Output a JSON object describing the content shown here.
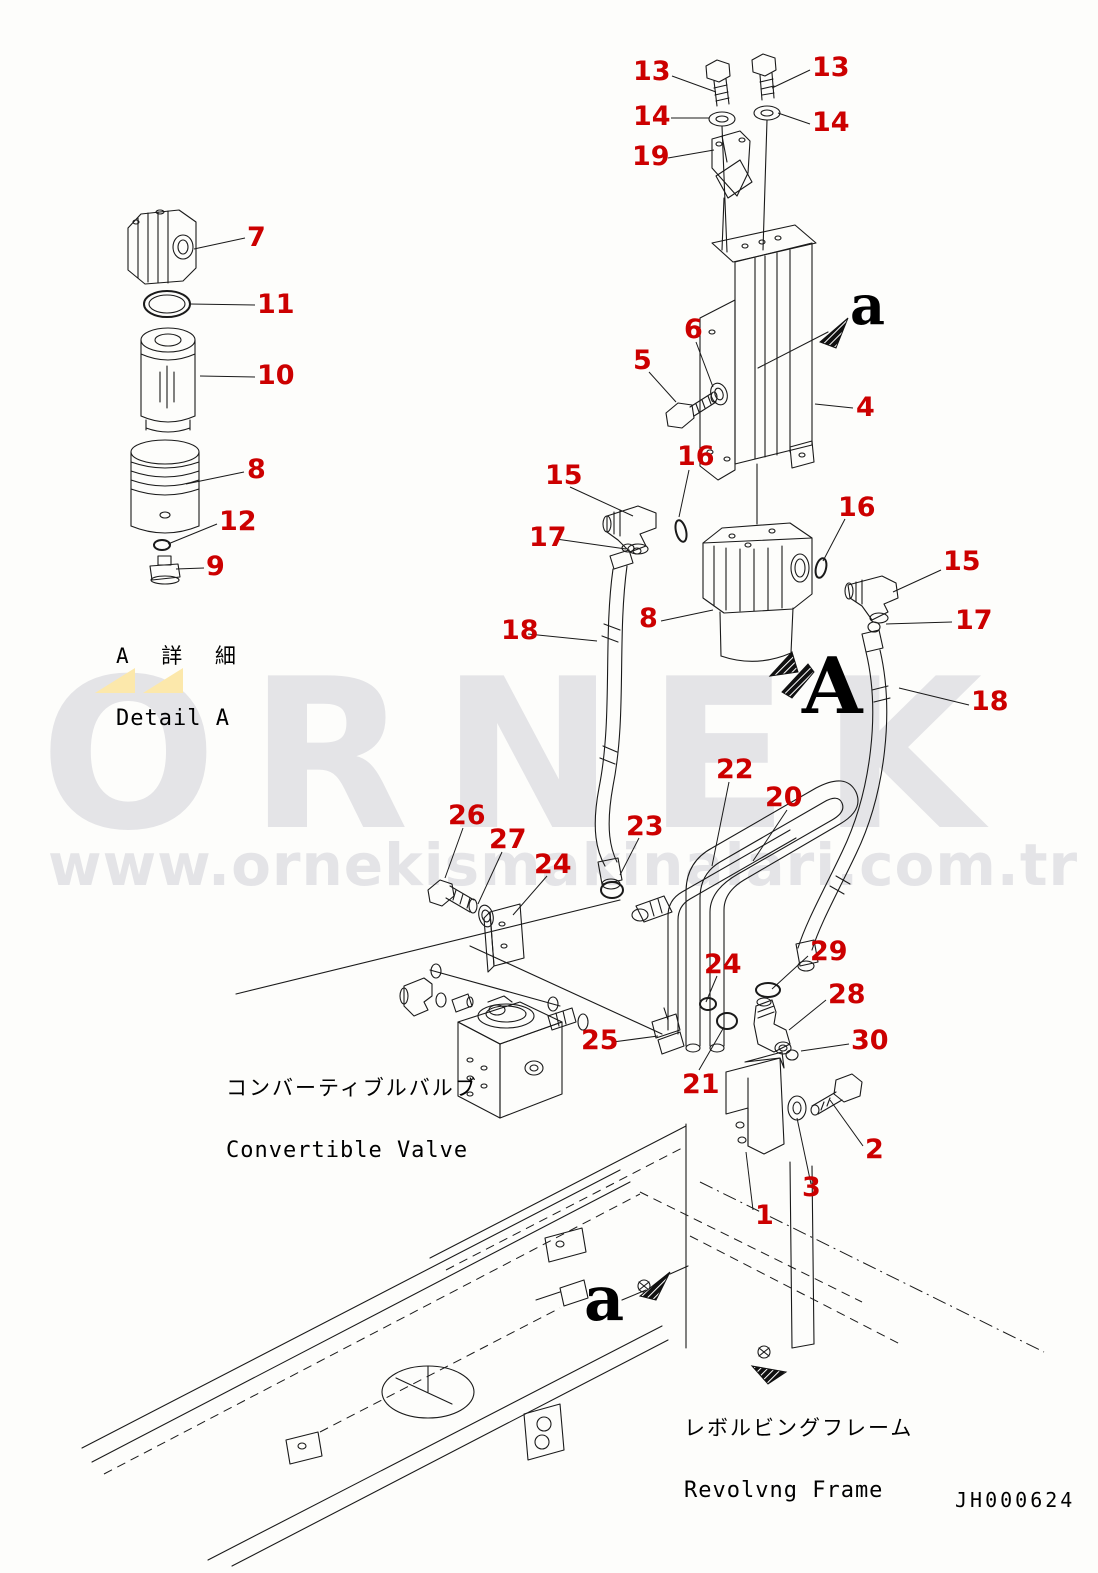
{
  "doc": {
    "drawing_number": "JH000624"
  },
  "colors": {
    "label_red": "#cc0000",
    "line_black": "#1a1a1a",
    "watermark_gray": "#e4e4e7",
    "watermark_yellow": "#fce8ab",
    "paper": "#fdfdfb"
  },
  "watermark": {
    "brand": "ORNEK",
    "url": "www.ornekismakinalari.com.tr"
  },
  "annotations": {
    "detail_a_jp": "A 詳 細",
    "detail_a_en": "Detail A",
    "convertible_valve_jp": "コンバーティブルバルブ",
    "convertible_valve_en": "Convertible Valve",
    "revolving_frame_jp": "レボルビングフレーム",
    "revolving_frame_en": "Revolvng Frame"
  },
  "view_markers": [
    {
      "label": "a",
      "position": "top-right"
    },
    {
      "label": "A",
      "position": "center"
    },
    {
      "label": "a",
      "position": "bottom"
    }
  ],
  "part_labels": [
    {
      "text": "13",
      "x": 633,
      "y": 58,
      "leader": [
        672,
        76,
        716,
        92
      ]
    },
    {
      "text": "13",
      "x": 812,
      "y": 54,
      "leader": [
        810,
        70,
        772,
        88
      ]
    },
    {
      "text": "14",
      "x": 633,
      "y": 103,
      "leader": [
        671,
        118,
        709,
        118
      ]
    },
    {
      "text": "14",
      "x": 812,
      "y": 109,
      "leader": [
        810,
        124,
        778,
        113
      ]
    },
    {
      "text": "19",
      "x": 632,
      "y": 143,
      "leader": [
        668,
        158,
        714,
        150
      ]
    },
    {
      "text": "7",
      "x": 247,
      "y": 224,
      "leader": [
        245,
        238,
        194,
        249
      ]
    },
    {
      "text": "11",
      "x": 257,
      "y": 291,
      "leader": [
        255,
        305,
        190,
        304
      ]
    },
    {
      "text": "10",
      "x": 257,
      "y": 362,
      "leader": [
        255,
        377,
        200,
        376
      ]
    },
    {
      "text": "5",
      "x": 633,
      "y": 347,
      "leader": [
        649,
        372,
        676,
        402
      ]
    },
    {
      "text": "6",
      "x": 684,
      "y": 316,
      "leader": [
        696,
        342,
        713,
        387
      ]
    },
    {
      "text": "4",
      "x": 856,
      "y": 394,
      "leader": [
        853,
        408,
        815,
        404
      ]
    },
    {
      "text": "15",
      "x": 545,
      "y": 462,
      "leader": [
        570,
        487,
        633,
        516
      ]
    },
    {
      "text": "16",
      "x": 677,
      "y": 443,
      "leader": [
        689,
        470,
        679,
        517
      ]
    },
    {
      "text": "17",
      "x": 529,
      "y": 524,
      "leader": [
        556,
        539,
        626,
        549
      ]
    },
    {
      "text": "16",
      "x": 838,
      "y": 494,
      "leader": [
        845,
        519,
        823,
        561
      ]
    },
    {
      "text": "15",
      "x": 943,
      "y": 548,
      "leader": [
        941,
        570,
        893,
        592
      ]
    },
    {
      "text": "17",
      "x": 955,
      "y": 607,
      "leader": [
        952,
        622,
        886,
        624
      ]
    },
    {
      "text": "18",
      "x": 501,
      "y": 617,
      "leader": [
        528,
        634,
        597,
        641
      ]
    },
    {
      "text": "8",
      "x": 639,
      "y": 605,
      "leader": [
        661,
        621,
        713,
        610
      ]
    },
    {
      "text": "18",
      "x": 971,
      "y": 688,
      "leader": [
        969,
        705,
        899,
        688
      ]
    },
    {
      "text": "8",
      "x": 247,
      "y": 456,
      "leader": [
        244,
        472,
        186,
        484
      ]
    },
    {
      "text": "12",
      "x": 219,
      "y": 508,
      "leader": [
        217,
        524,
        168,
        544
      ]
    },
    {
      "text": "9",
      "x": 206,
      "y": 553,
      "leader": [
        204,
        568,
        176,
        569
      ]
    },
    {
      "text": "22",
      "x": 716,
      "y": 756,
      "leader": [
        729,
        782,
        712,
        866
      ]
    },
    {
      "text": "20",
      "x": 765,
      "y": 784,
      "leader": [
        787,
        810,
        753,
        861
      ]
    },
    {
      "text": "26",
      "x": 448,
      "y": 802,
      "leader": [
        463,
        828,
        445,
        878
      ]
    },
    {
      "text": "27",
      "x": 489,
      "y": 826,
      "leader": [
        502,
        852,
        478,
        904
      ]
    },
    {
      "text": "23",
      "x": 626,
      "y": 813,
      "leader": [
        639,
        838,
        620,
        875
      ]
    },
    {
      "text": "24",
      "x": 534,
      "y": 851,
      "leader": [
        547,
        876,
        513,
        915
      ]
    },
    {
      "text": "24",
      "x": 704,
      "y": 951,
      "leader": [
        717,
        976,
        706,
        1002
      ]
    },
    {
      "text": "29",
      "x": 810,
      "y": 938,
      "leader": [
        808,
        956,
        772,
        989
      ]
    },
    {
      "text": "28",
      "x": 828,
      "y": 981,
      "leader": [
        826,
        1000,
        789,
        1030
      ]
    },
    {
      "text": "30",
      "x": 851,
      "y": 1027,
      "leader": [
        849,
        1044,
        801,
        1051
      ]
    },
    {
      "text": "25",
      "x": 581,
      "y": 1027,
      "leader": [
        613,
        1042,
        658,
        1036
      ]
    },
    {
      "text": "21",
      "x": 682,
      "y": 1071,
      "leader": [
        699,
        1070,
        724,
        1027
      ]
    },
    {
      "text": "2",
      "x": 865,
      "y": 1136,
      "leader": [
        863,
        1146,
        830,
        1100
      ]
    },
    {
      "text": "3",
      "x": 802,
      "y": 1174,
      "leader": [
        811,
        1184,
        797,
        1118
      ]
    },
    {
      "text": "1",
      "x": 755,
      "y": 1202,
      "leader": [
        753,
        1210,
        746,
        1152
      ]
    }
  ]
}
